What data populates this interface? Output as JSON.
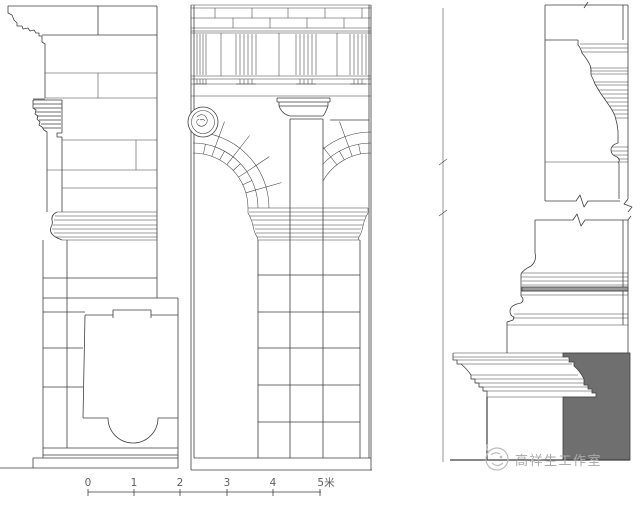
{
  "scale_bar": {
    "labels": [
      "0",
      "1",
      "2",
      "3",
      "4",
      "5米"
    ]
  },
  "watermark": {
    "text": "高祥生工作室"
  },
  "colors": {
    "line": "#3f3f3f",
    "section_fill": "#6f6f6f",
    "molding_band_fill": "#9a9a9a",
    "watermark": "#a9a9a9",
    "scale_text": "#5f5f5f",
    "background": "#ffffff"
  }
}
